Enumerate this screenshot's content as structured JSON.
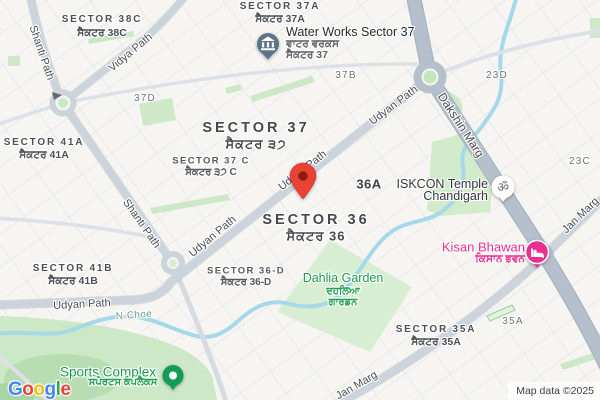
{
  "labels": {
    "sector_38c": {
      "en": "SECTOR 38C",
      "pa": "ਸੈਕਟਰ 38C"
    },
    "sector_37a": {
      "en": "SECTOR 37A",
      "pa": "ਸੈਕਟਰ 37A"
    },
    "sector_37": {
      "en": "SECTOR 37",
      "pa": "ਸੈਕਟਰ ੩੭"
    },
    "sector_37c": {
      "en": "SECTOR 37 C",
      "pa": "ਸੈਕਟਰ ੩੭ C"
    },
    "sector_36": {
      "en": "SECTOR 36",
      "pa": "ਸੈਕਟਰ 36"
    },
    "sector_36d": {
      "en": "SECTOR 36-D",
      "pa": "ਸੈਕਟਰ 36-D"
    },
    "sector_41a": {
      "en": "SECTOR 41A",
      "pa": "ਸੈਕਟਰ 41A"
    },
    "sector_41b": {
      "en": "SECTOR 41B",
      "pa": "ਸੈਕਟਰ 41B"
    },
    "sector_35a": {
      "en": "SECTOR 35A",
      "pa": "ਸੈਕਟਰ 35A"
    },
    "block_36a": "36A",
    "block_37b": "37B",
    "block_37d": "37D",
    "block_35a": "35A",
    "block_23c": "23C",
    "block_23d": "23D"
  },
  "roads": {
    "udyan_path": "Udyan Path",
    "shanti_path": "Shanti Path",
    "vidya_path": "Vidya Path",
    "dakshin_marg": "Dakshin Marg",
    "jan_marg": "Jan Marg",
    "n_choe": "N-Choe"
  },
  "pois": {
    "water_works": {
      "name": "Water Works Sector 37",
      "pa1": "ਵਾਟਰ ਵਰਕਸ",
      "pa2": "ਸੈਕਟਰ 37"
    },
    "iskcon": {
      "line1": "ISKCON Temple",
      "line2": "Chandigarh"
    },
    "dahlia": {
      "en": "Dahlia Garden",
      "pa1": "ਦਹਲਿਆ",
      "pa2": "ਗਾਰਡਨ"
    },
    "kisan": {
      "en": "Kisan Bhawan",
      "pa": "ਕਿਸਾਨ ਭਵਨ"
    },
    "sports": {
      "en": "Sports Complex",
      "pa": "ਸਪੋਰਟਸ ਕੰਪਲੈਕਸ"
    }
  },
  "icons": {
    "water_works_icon": "bank-building-pin",
    "iskcon_icon": "om-badge ॐ",
    "kisan_icon": "bed-lodging-badge",
    "sports_icon": "park-dot-badge",
    "destination_icon": "red-location-pin",
    "one_way_icon": "arrow"
  },
  "colors": {
    "poi_green": "#1b9a4e",
    "poi_pink": "#ea2e92",
    "pin_red": "#ea4335",
    "water_blue": "#a5d9e9",
    "park_green": "#cfe9c8",
    "road_major": "#b6c0cc"
  },
  "footer": {
    "logo_letters": [
      "G",
      "o",
      "o",
      "g",
      "l",
      "e"
    ],
    "attribution": "Map data ©2025"
  }
}
